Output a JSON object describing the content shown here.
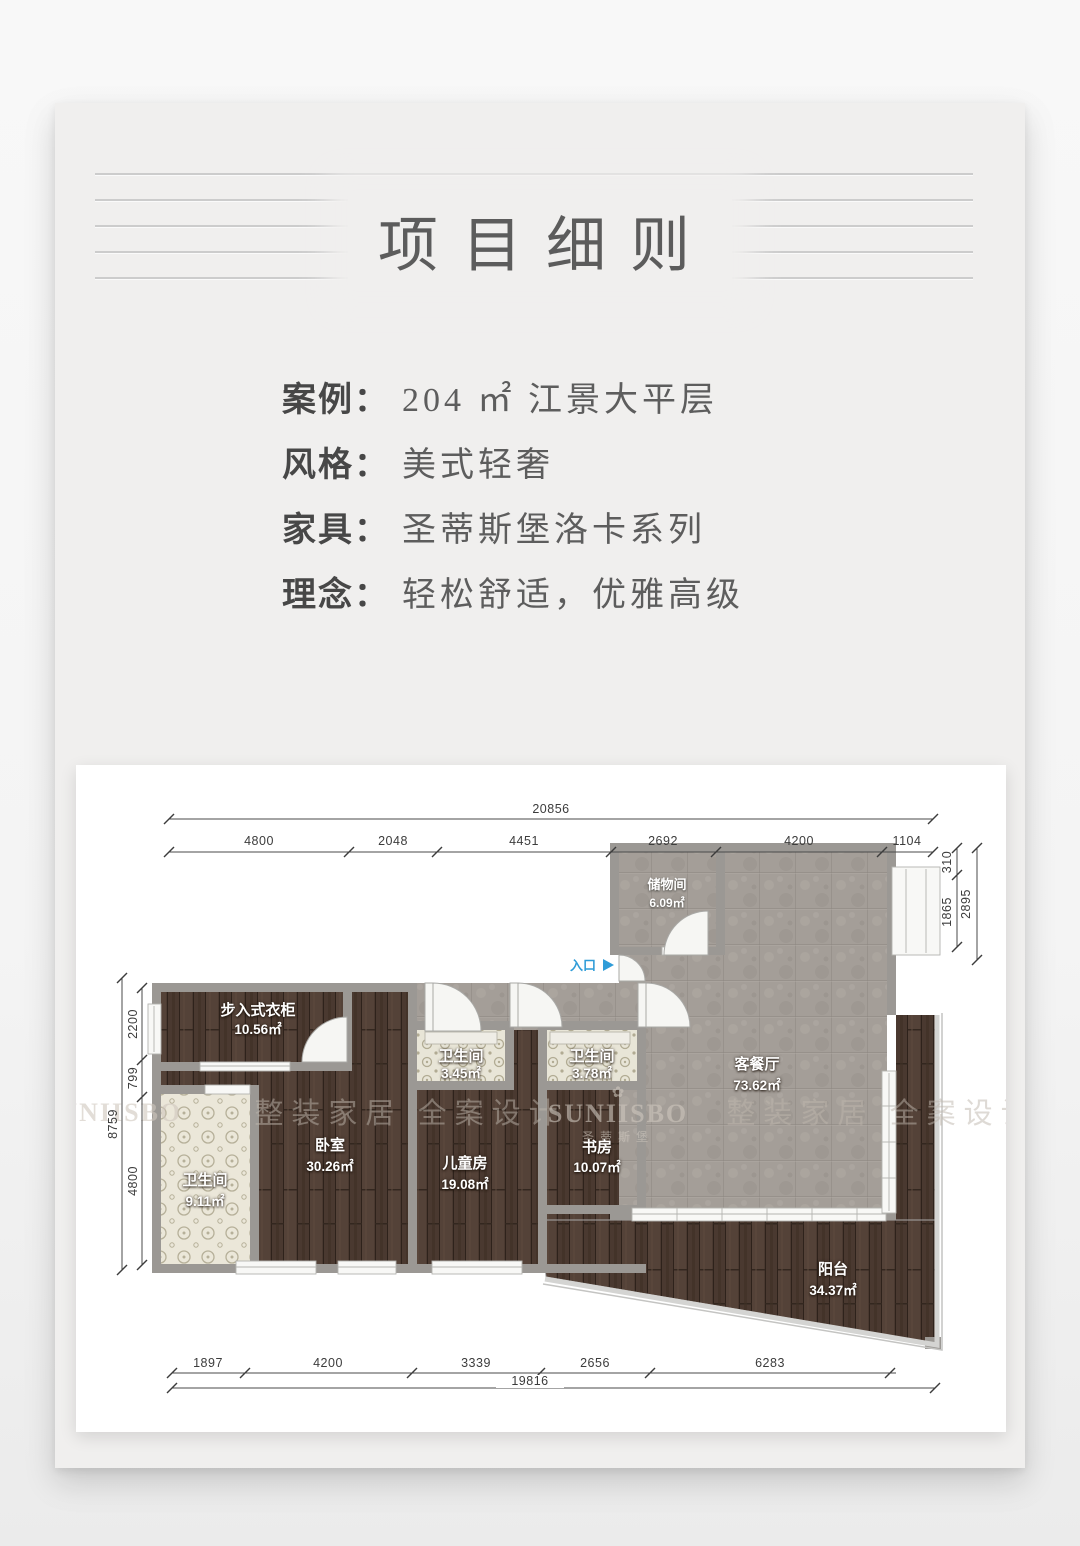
{
  "header": {
    "title": "项目细则"
  },
  "info": {
    "rows": [
      {
        "label": "案例：",
        "value": "204 ㎡ 江景大平层"
      },
      {
        "label": "风格：",
        "value": "美式轻奢"
      },
      {
        "label": "家具：",
        "value": "圣蒂斯堡洛卡系列"
      },
      {
        "label": "理念：",
        "value": "轻松舒适，优雅高级"
      }
    ]
  },
  "plan": {
    "entry_label": "入口",
    "rooms": {
      "storage": {
        "name": "储物间",
        "area": "6.09㎡"
      },
      "living": {
        "name": "客餐厅",
        "area": "73.62㎡"
      },
      "closet": {
        "name": "步入式衣柜",
        "area": "10.56㎡"
      },
      "bath_a": {
        "name": "卫生间",
        "area": "3.45㎡"
      },
      "bath_b": {
        "name": "卫生间",
        "area": "3.78㎡"
      },
      "bedroom": {
        "name": "卧室",
        "area": "30.26㎡"
      },
      "kids": {
        "name": "儿童房",
        "area": "19.08㎡"
      },
      "study": {
        "name": "书房",
        "area": "10.07㎡"
      },
      "bath_master": {
        "name": "卫生间",
        "area": "9.11㎡"
      },
      "balcony": {
        "name": "阳台",
        "area": "34.37㎡"
      }
    },
    "dims": {
      "top_total": "20856",
      "top_segments": [
        "4800",
        "2048",
        "4451",
        "2692",
        "4200",
        "1104"
      ],
      "right_segments": [
        "310",
        "1865"
      ],
      "right_outer": "2895",
      "left_outer": "8759",
      "left_segments": [
        "2200",
        "799",
        "4800"
      ],
      "bottom_segments": [
        "1897",
        "4200",
        "3339",
        "2656",
        "6283"
      ],
      "bottom_total": "19816"
    },
    "watermarks": {
      "left_partial": "SUNIISBO",
      "slogan_left": "整装家居 全案设计",
      "brand_icon": "✿",
      "brand": "SUNIISBO",
      "brand_sub": "圣蒂斯堡",
      "slogan_right": "整装家居 全案设计"
    }
  },
  "colors": {
    "entry_accent": "#2f9cd8",
    "wall_gray": "#9b9894",
    "wood_floor": "#4a3930",
    "tile_floor": "#a49e98",
    "card_bg": "#f0efee"
  }
}
